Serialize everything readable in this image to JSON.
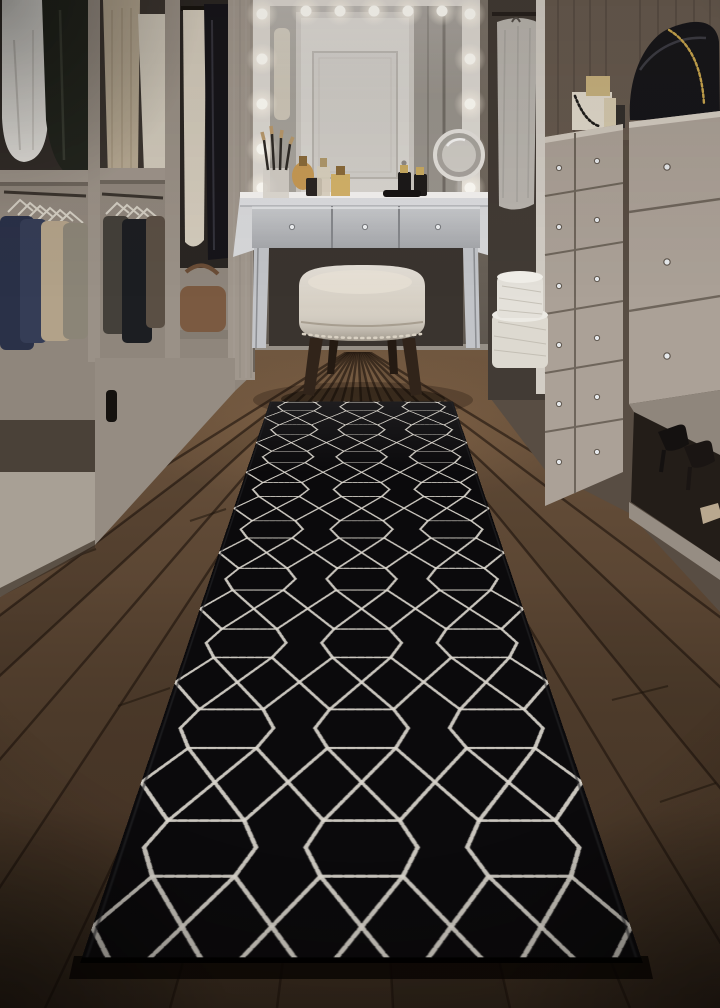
{
  "scene": {
    "description": "Walk-in closet with Hollywood-lit vanity mirror, mirrored dressing table with perfumes, cream nailhead ottoman, greige wardrobe with hanging clothes, dresser with crystal knobs, black handbag, hat boxes and heels, and a black geometric trellis runner rug on dark walnut plank flooring",
    "objects": [
      "vanity-mirror",
      "mirror-bulbs",
      "reflected-door",
      "magnifying-mirror",
      "vanity-table",
      "perfume-bottles",
      "makeup-brushes",
      "ottoman-stool",
      "left-wardrobe",
      "hanging-clothes",
      "clothes-hangers",
      "leather-bag",
      "right-dresser",
      "drawer-knobs",
      "handbag",
      "jewelry-box",
      "garment-bags",
      "hat-boxes",
      "high-heels",
      "wood-floor",
      "runner-rug"
    ]
  },
  "palette": {
    "wall": "#746b61",
    "wardrobe_greige": "#8f867c",
    "dresser_greige": "#aba197",
    "dark_wood_panel": "#665a4f",
    "floor_brown": "#54402e",
    "rug_black": "#0b0a0c",
    "rug_pattern": "#d9d5cc",
    "stool_cream": "#d4cdc1",
    "stool_leg": "#31241a",
    "mirror_frame": "#dedad4",
    "mirror_glass": "#b2aea8",
    "door_white": "#d9d6d1",
    "bulb": "#fffef8",
    "handbag_black": "#16161a",
    "amber_perfume": "#c79a55",
    "hatbox_white": "#ddd9d0"
  }
}
